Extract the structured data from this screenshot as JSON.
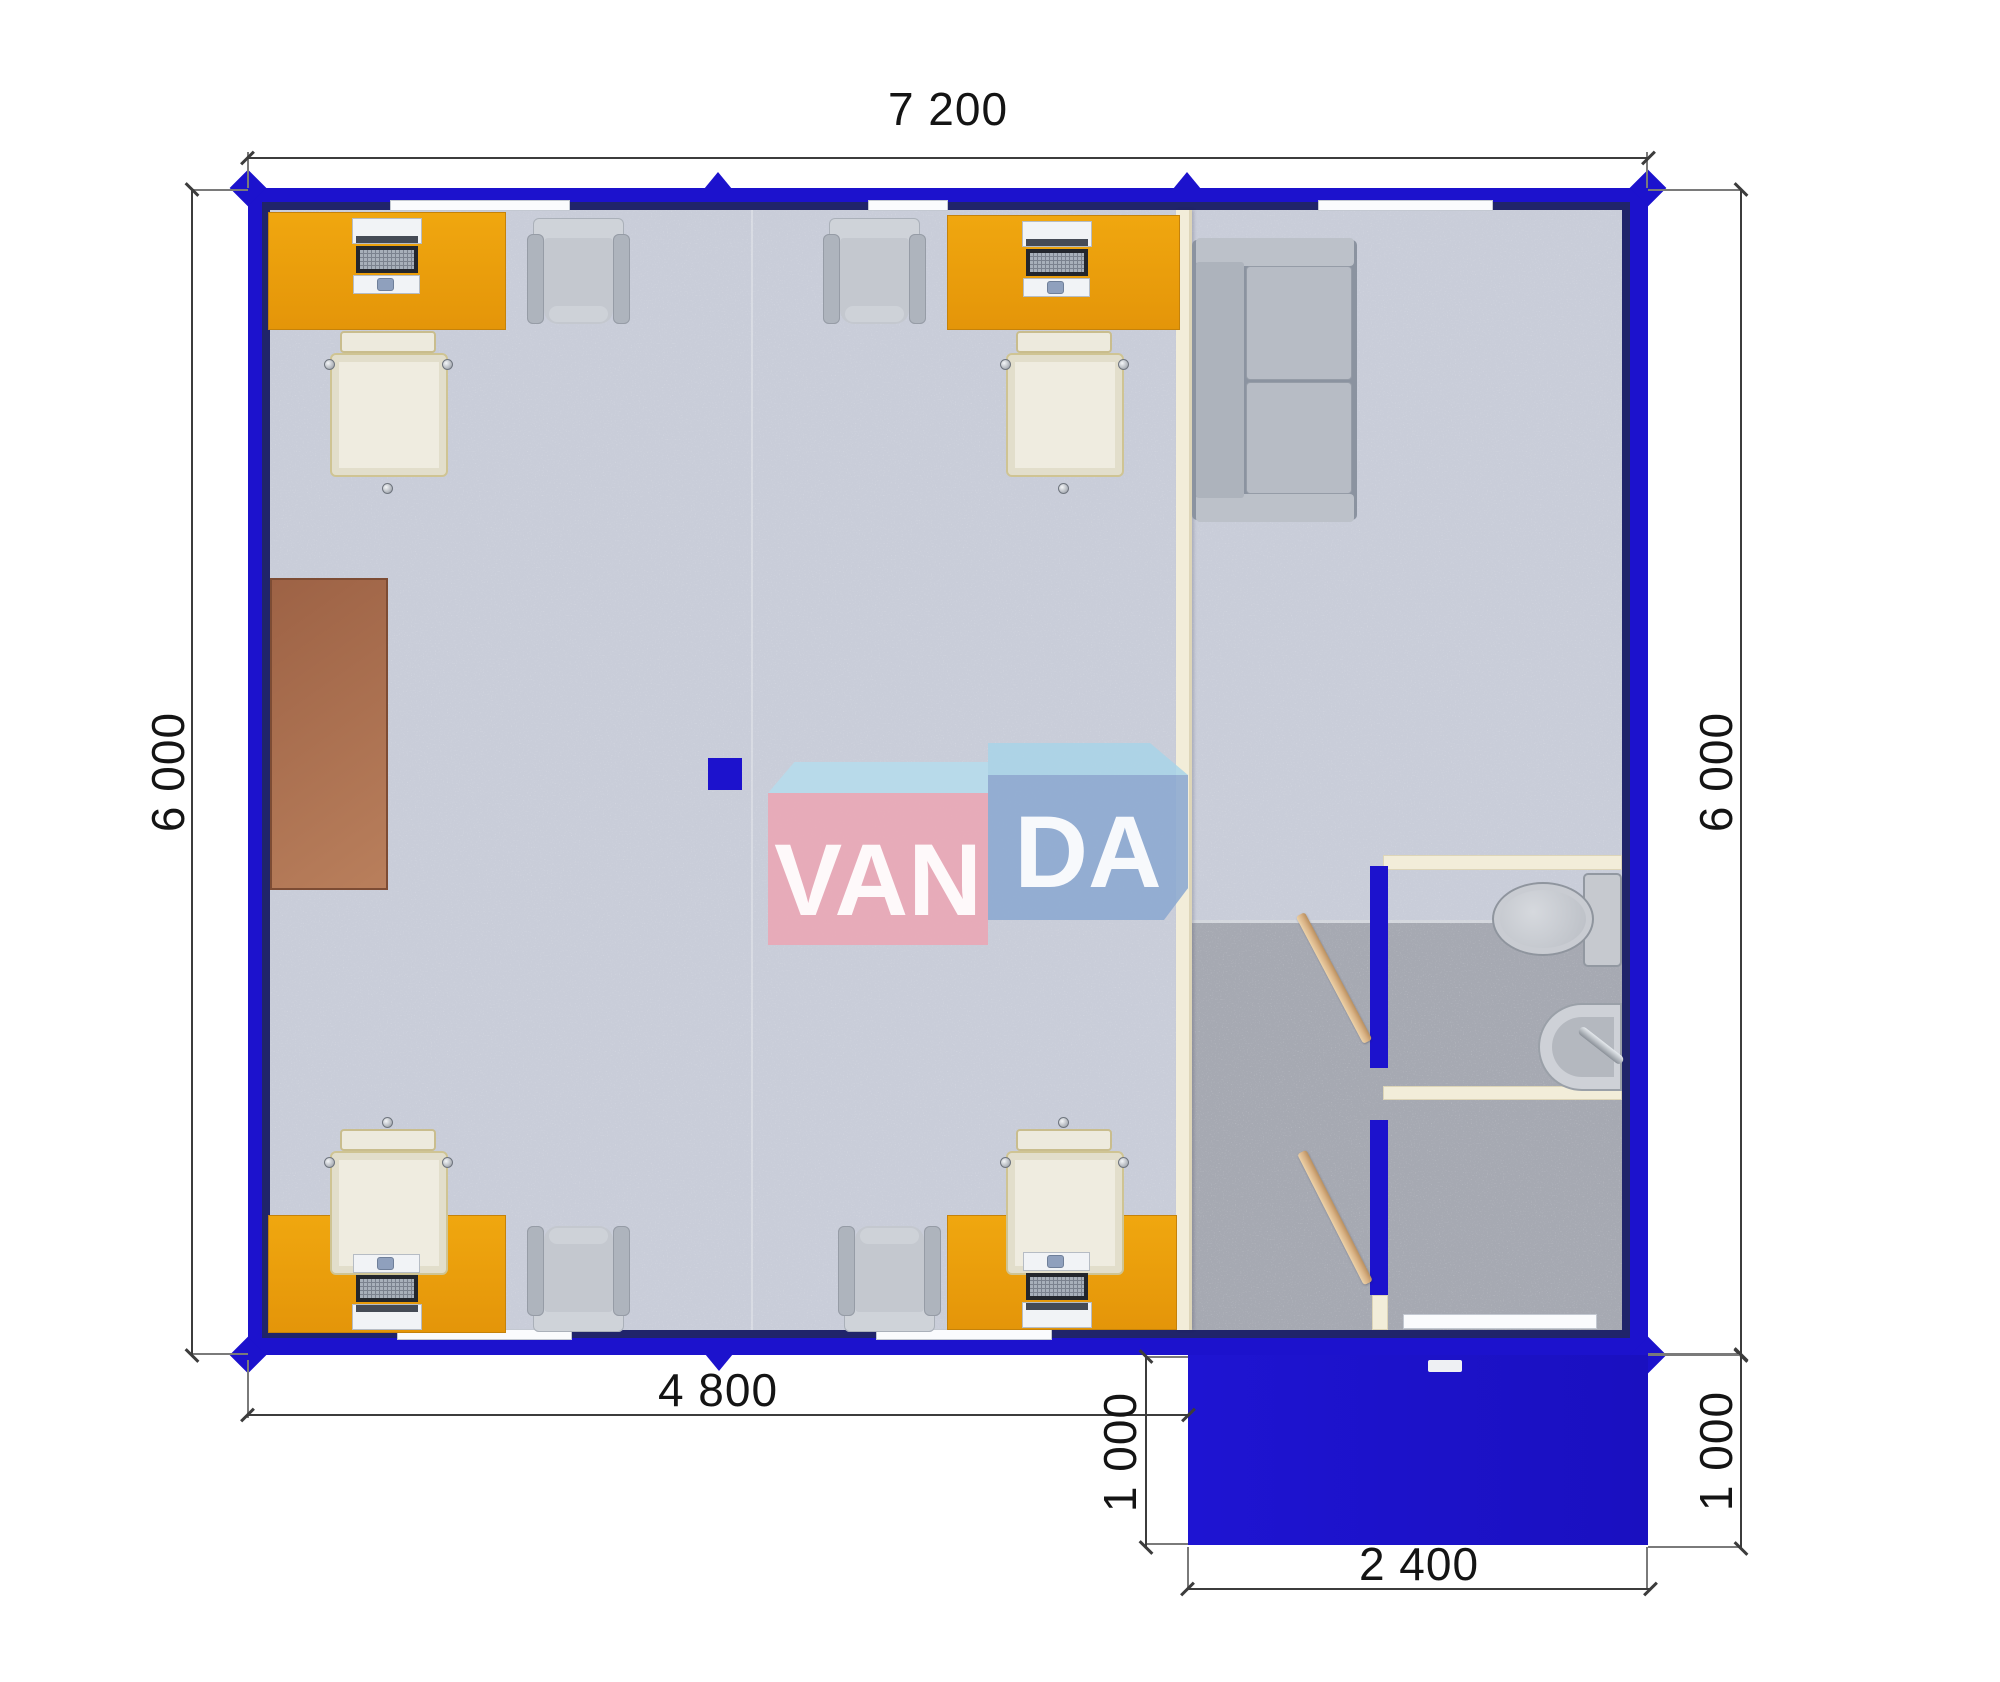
{
  "dimensions": {
    "top": "7 200",
    "left": "6 000",
    "right": "6 000",
    "office_width": "4 800",
    "porch_depth_left": "1 000",
    "porch_depth_right": "1 000",
    "porch_width": "2 400"
  },
  "watermark": {
    "brand": "VANDA",
    "part1": "VAN",
    "part2": "DA"
  },
  "colors": {
    "wall_blue": "#1c12cd",
    "wall_shadow": "#20246a",
    "desk_orange": "#ec9f0d",
    "floor_light": "#c9cdd9",
    "floor_gray": "#a6a9b2",
    "partition_cream": "#f2edd9",
    "cabinet_brown": "#a96c4d",
    "watermark_pink": "#eaa6b4",
    "watermark_blue": "#8ba8d0",
    "door_wood": "#d8b184"
  }
}
